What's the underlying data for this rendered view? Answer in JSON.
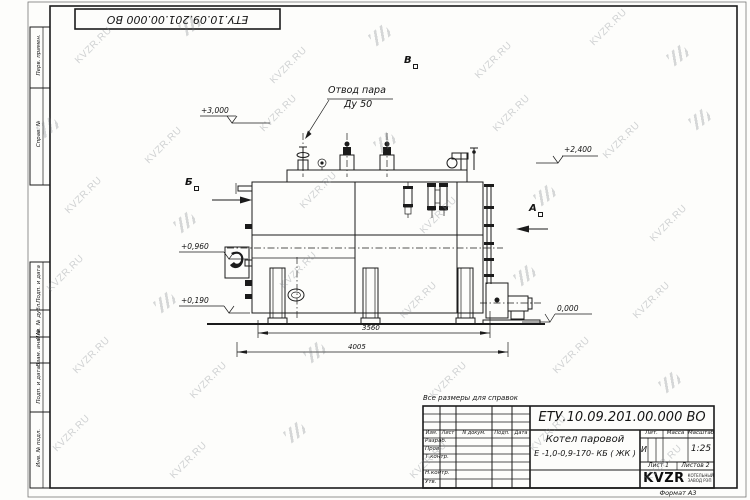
{
  "doc_number": "ЕТУ.10.09.201.00.000  ВО",
  "watermark": {
    "text": "KVZR.RU"
  },
  "notes": {
    "reference": "Все размеры для справок",
    "format": "Формат А3"
  },
  "margin_boxes": {
    "top": [
      "Перв. примен.",
      "Справ. №"
    ],
    "bottom": [
      "Подп. и дата",
      "Инв. № дубл.",
      "Взам. инв. №",
      "Подп. и дата",
      "Инв. № подл."
    ]
  },
  "drawing": {
    "steam_outlet": {
      "line1": "Отвод пара",
      "line2": "Ду 50"
    },
    "views": {
      "a": "А",
      "b": "Б",
      "v": "В"
    },
    "elevations": {
      "top": "+3,000",
      "right_top": "+2,400",
      "hatch": "+0,960",
      "firebox": "+0,190",
      "ground": "0,000"
    },
    "dimensions": {
      "leg_span": "3560",
      "overall_length": "4005"
    }
  },
  "title_block": {
    "product_name": {
      "line1": "Котел паровой",
      "line2": "Е -1,0-0,9-170- КБ ( ЖК )"
    },
    "headers": {
      "lit": "Лит.",
      "mass": "Масса",
      "scale": "Масштаб"
    },
    "values": {
      "lit": "И",
      "scale": "1:25"
    },
    "sheet_info": {
      "sheet": "Лист 1",
      "sheets": "Листов 2"
    },
    "signature_headers": [
      "Изм.",
      "Лист",
      "N докум.",
      "Подп.",
      "Дата"
    ],
    "signature_rows": [
      "Разраб.",
      "Пров.",
      "Т.контр.",
      "Н.контр.",
      "Утв."
    ],
    "logo": {
      "name": "KVZR",
      "tagline1": "КОТЕЛЬНЫЙ",
      "tagline2": "ЗАВОД РЭП"
    }
  }
}
